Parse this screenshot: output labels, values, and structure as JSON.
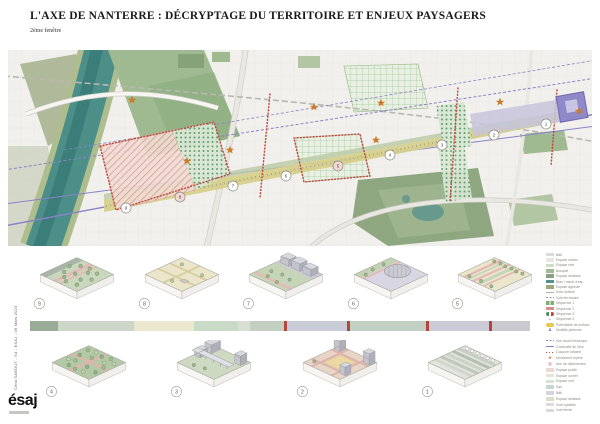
{
  "header": {
    "title": "L'AXE DE NANTERRE : DÉCRYPTAGE DU TERRITOIRE ET ENJEUX PAYSAGERS",
    "subtitle": "2ème fenêtre"
  },
  "map": {
    "colors": {
      "river": "#4b8f88",
      "axis_purple": "#8a82c8",
      "band_yellow": "#d7d08b",
      "star_orange": "#cd7a29",
      "red_dotted": "#bf4a3f",
      "park_green": "#8ea781",
      "arch_purple": "#8f88c9"
    },
    "stations": [
      {
        "n": "9",
        "x": 118,
        "y": 158
      },
      {
        "n": "8",
        "x": 172,
        "y": 147,
        "pink": true
      },
      {
        "n": "7",
        "x": 225,
        "y": 136
      },
      {
        "n": "6",
        "x": 278,
        "y": 126
      },
      {
        "n": "5",
        "x": 330,
        "y": 116,
        "pink": true
      },
      {
        "n": "4",
        "x": 382,
        "y": 105
      },
      {
        "n": "3",
        "x": 434,
        "y": 95
      },
      {
        "n": "2",
        "x": 486,
        "y": 85
      },
      {
        "n": "1",
        "x": 538,
        "y": 74
      }
    ],
    "stars": [
      {
        "x": 124,
        "y": 50
      },
      {
        "x": 179,
        "y": 111
      },
      {
        "x": 222,
        "y": 100
      },
      {
        "x": 306,
        "y": 57
      },
      {
        "x": 368,
        "y": 90
      },
      {
        "x": 373,
        "y": 53
      },
      {
        "x": 492,
        "y": 52
      },
      {
        "x": 571,
        "y": 61
      }
    ]
  },
  "diagrams": {
    "top": [
      {
        "number": "9",
        "style": "woodland"
      },
      {
        "number": "8",
        "style": "heath"
      },
      {
        "number": "7",
        "style": "slope"
      },
      {
        "number": "6",
        "style": "oval"
      },
      {
        "number": "5",
        "style": "boulevard"
      }
    ],
    "bottom": [
      {
        "number": "4",
        "style": "garden"
      },
      {
        "number": "3",
        "style": "viaduct"
      },
      {
        "number": "2",
        "style": "plaza"
      },
      {
        "number": "1",
        "style": "terraces"
      }
    ]
  },
  "sequence_strip": {
    "tick_color": "#b5463c",
    "segments": [
      {
        "color": "#9aab97",
        "width": 28
      },
      {
        "color": "#cdd6c9",
        "width": 76
      },
      {
        "color": "#ebe8cf",
        "width": 60
      },
      {
        "color": "#c9dac6",
        "width": 44
      },
      {
        "color": "#d9ddd3",
        "width": 12
      },
      {
        "color": "#c3cfc0",
        "width": 34
      },
      {
        "color": "#b5463c",
        "width": 3,
        "tick": true
      },
      {
        "color": "#c9ccd6",
        "width": 60
      },
      {
        "color": "#b5463c",
        "width": 3,
        "tick": true
      },
      {
        "color": "#c2cfc3",
        "width": 76
      },
      {
        "color": "#b5463c",
        "width": 3,
        "tick": true
      },
      {
        "color": "#ccccd8",
        "width": 60
      },
      {
        "color": "#b5463c",
        "width": 3,
        "tick": true
      },
      {
        "color": "#c9c9cf",
        "width": 38
      }
    ]
  },
  "legend_map": {
    "items": [
      {
        "type": "swatch",
        "color": "#dbdad4",
        "label": "Bâti"
      },
      {
        "type": "swatch",
        "color": "#e9e7dd",
        "label": "Espace urbain"
      },
      {
        "type": "swatch",
        "color": "#cfdcc6",
        "label": "Espace vert"
      },
      {
        "type": "swatch",
        "color": "#a3bb95",
        "label": "Bosquet"
      },
      {
        "type": "swatch",
        "color": "#87a17c",
        "label": "Espace délaissé"
      },
      {
        "type": "swatch",
        "color": "#53908a",
        "label": "Bras / miroir d'eau"
      },
      {
        "type": "swatch",
        "color": "#9aa87b",
        "label": "Espace agricole"
      },
      {
        "type": "line",
        "color": "#b3b3ab",
        "label": "Voie routière"
      },
      {
        "type": "dashline",
        "color": "#9a9a94",
        "label": "Voie ferroviaire"
      },
      {
        "type": "duo",
        "color": "#7fae6e",
        "label": "Séquence 1"
      },
      {
        "type": "bar",
        "color": "#d98d84",
        "label": "Séquence 2"
      },
      {
        "type": "dots2",
        "color": "#4f8f5a",
        "label": "Séquence 3"
      },
      {
        "type": "glyph",
        "color": "#5a6fc0",
        "char": "+",
        "label": "Séquence 4"
      },
      {
        "type": "blob",
        "color": "#e5c84e",
        "label": "Potentialité de surface"
      },
      {
        "type": "glyph",
        "color": "#8a82c8",
        "char": "♟",
        "label": "Mobilité piétonne"
      }
    ]
  },
  "legend_axis": {
    "items": [
      {
        "type": "dashline",
        "color": "#8a82c8",
        "label": "Axe visuel historique"
      },
      {
        "type": "line",
        "color": "#8a82c8",
        "label": "Continuité de l'axe"
      },
      {
        "type": "dotline",
        "color": "#bf4a3f",
        "label": "Coupure urbaine"
      },
      {
        "type": "glyph",
        "color": "#cd7a29",
        "char": "★",
        "label": "Monument repère"
      },
      {
        "type": "glyph",
        "color": "#bf4a3f",
        "char": "◎",
        "label": "Aire de déploiement"
      },
      {
        "type": "swatch",
        "color": "#ead9d4",
        "label": "Espace public"
      },
      {
        "type": "swatch",
        "color": "#e8e4d4",
        "label": "Espace ouvert"
      },
      {
        "type": "swatch",
        "color": "#d9e2d0",
        "label": "Espace vert"
      },
      {
        "type": "swatch",
        "color": "#c6d6d2",
        "label": "Eau"
      },
      {
        "type": "swatch",
        "color": "#d6d6da",
        "label": "Bâti"
      },
      {
        "type": "swatch",
        "color": "#dcdcca",
        "label": "Espace délaissé"
      },
      {
        "type": "swatch",
        "color": "#e2d8de",
        "label": "Voie cyclable"
      },
      {
        "type": "swatch",
        "color": "#d8d8e2",
        "label": "Voie ferrée"
      }
    ]
  },
  "sidebar": {
    "credit": "Célia SABOUT - S4 - ESAJ - 09 Mars 2023",
    "logo": "ésaj"
  }
}
